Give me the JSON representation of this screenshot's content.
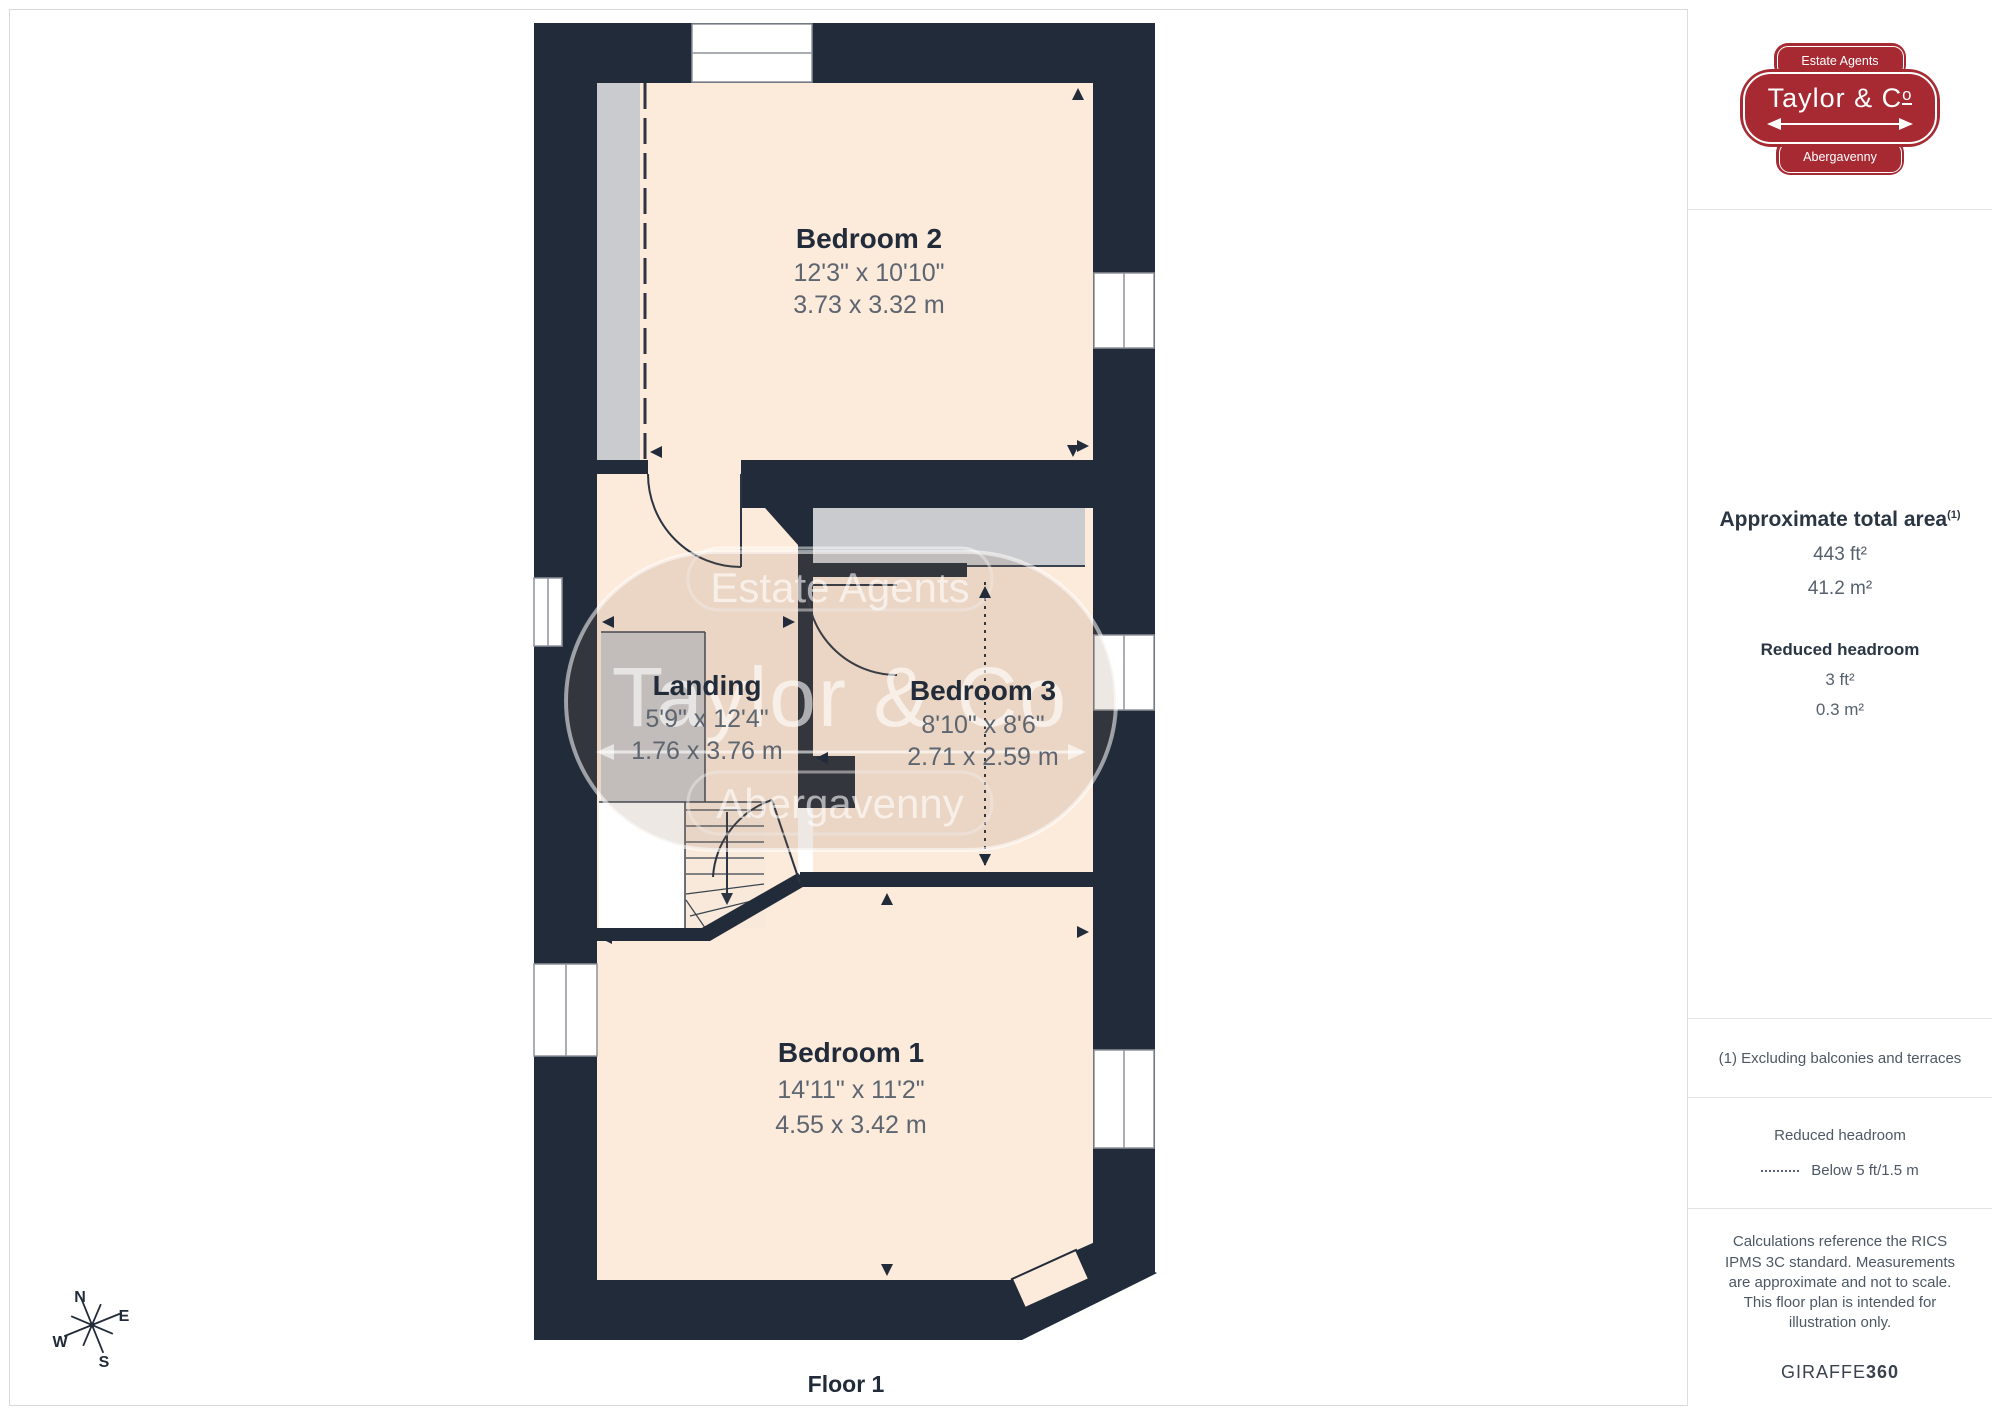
{
  "page": {
    "floor_label": "Floor 1"
  },
  "colors": {
    "wall": "#212b39",
    "floor": "#fceadb",
    "reduced_headroom_gray": "#c9cbce",
    "logo_red": "#a72a33",
    "text_dark": "#212b39",
    "text_dim": "#5d6570"
  },
  "plan": {
    "rooms": [
      {
        "name": "Bedroom 2",
        "imperial": "12'3\" x 10'10\"",
        "metric": "3.73 x 3.32 m"
      },
      {
        "name": "Landing",
        "imperial": "5'9\" x 12'4\"",
        "metric": "1.76 x 3.76 m"
      },
      {
        "name": "Bedroom 3",
        "imperial": "8'10\" x 8'6\"",
        "metric": "2.71 x 2.59 m"
      },
      {
        "name": "Bedroom 1",
        "imperial": "14'11\" x 11'2\"",
        "metric": "4.55 x 3.42 m"
      }
    ],
    "compass": {
      "n": "N",
      "e": "E",
      "s": "S",
      "w": "W"
    }
  },
  "watermark": {
    "top": "Estate Agents",
    "name": "Taylor & Co",
    "bottom": "Abergavenny"
  },
  "logo": {
    "top": "Estate Agents",
    "name_prefix": "Taylor & C",
    "name_o": "o",
    "bottom": "Abergavenny"
  },
  "sidebar": {
    "area_title": "Approximate total area",
    "area_sup": "(1)",
    "area_imperial": "443 ft²",
    "area_metric": "41.2 m²",
    "rh_title": "Reduced headroom",
    "rh_imperial": "3 ft²",
    "rh_metric": "0.3 m²",
    "note": "(1) Excluding balconies and terraces",
    "legend_title": "Reduced headroom",
    "legend_item": "Below 5 ft/1.5 m",
    "disclaimer": "Calculations reference the RICS IPMS 3C standard. Measurements are approximate and not to scale. This floor plan is intended for illustration only.",
    "brand_name": "GIRAFFE",
    "brand_suffix": "360"
  }
}
